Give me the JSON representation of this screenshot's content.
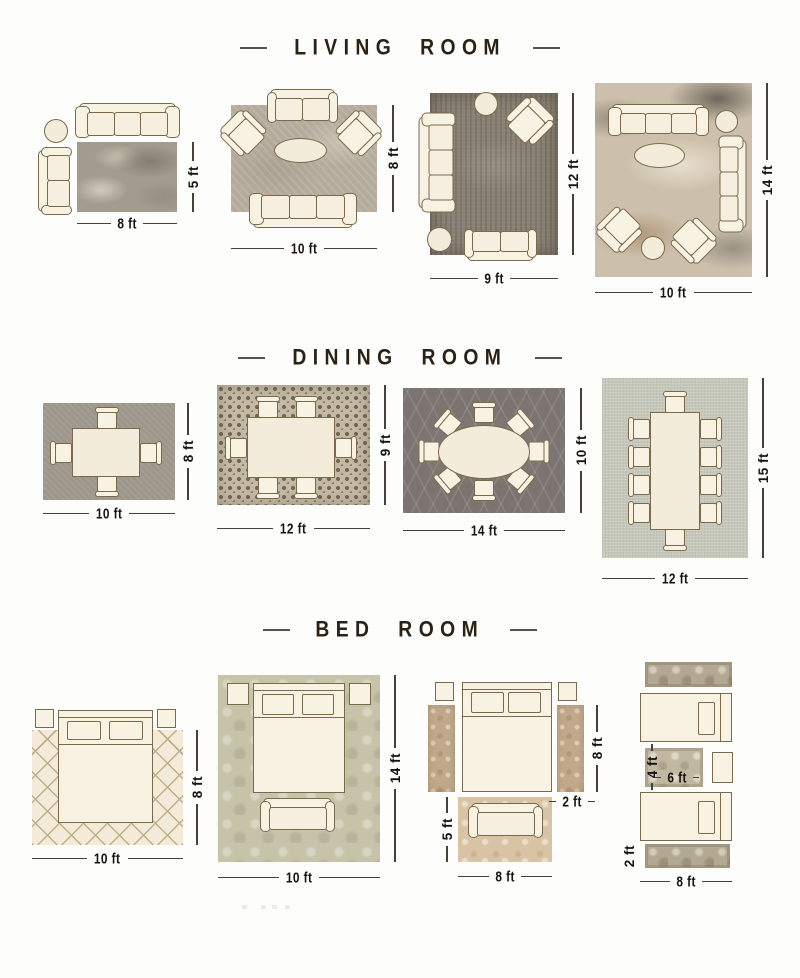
{
  "colors": {
    "background": "#fdfdfb",
    "title_text": "#2c2115",
    "dimension_text": "#17130e",
    "dimension_line": "#45403a",
    "furniture_fill": "#f8f2e3",
    "furniture_outline": "#7a6a4c"
  },
  "sections": {
    "living": {
      "title": "LIVING ROOM",
      "layouts": [
        {
          "width_label": "8 ft",
          "height_label": "5 ft"
        },
        {
          "width_label": "10 ft",
          "height_label": "8 ft"
        },
        {
          "width_label": "9 ft",
          "height_label": "12 ft"
        },
        {
          "width_label": "10 ft",
          "height_label": "14 ft"
        }
      ]
    },
    "dining": {
      "title": "DINING ROOM",
      "layouts": [
        {
          "width_label": "10 ft",
          "height_label": "8 ft"
        },
        {
          "width_label": "12 ft",
          "height_label": "9 ft"
        },
        {
          "width_label": "14 ft",
          "height_label": "10 ft"
        },
        {
          "width_label": "12 ft",
          "height_label": "15 ft"
        }
      ]
    },
    "bedroom": {
      "title": "BED ROOM",
      "layouts": [
        {
          "width_label": "10 ft",
          "height_label": "8 ft"
        },
        {
          "width_label": "10 ft",
          "height_label": "14 ft"
        },
        {
          "runner_height_label": "8 ft",
          "runner_width_label": "2 ft",
          "accent_rug_height_label": "5 ft",
          "accent_rug_width_label": "8 ft"
        },
        {
          "accent_rug_height_label": "4 ft",
          "accent_rug_width_label": "6 ft",
          "runner_height_label": "2 ft",
          "runner_width_label": "8 ft"
        }
      ]
    }
  }
}
